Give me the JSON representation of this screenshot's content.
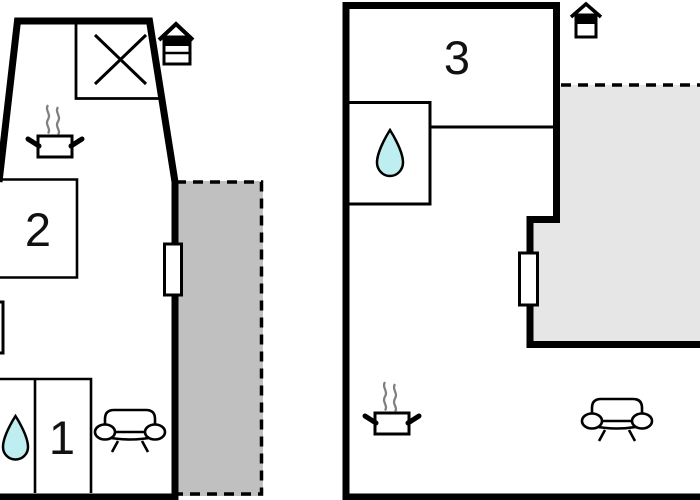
{
  "plans": [
    {
      "name": "floor-plan-left",
      "rooms": [
        {
          "label": "2"
        },
        {
          "label": "1"
        }
      ],
      "icons": [
        "stairs-x-box",
        "entrance-icon",
        "stove-icon",
        "water-drop-icon",
        "sofa-icon"
      ],
      "areas": [
        "terrace"
      ],
      "windows": 3
    },
    {
      "name": "floor-plan-right",
      "rooms": [
        {
          "label": "3"
        }
      ],
      "icons": [
        "entrance-icon",
        "water-drop-icon",
        "stove-icon",
        "sofa-icon"
      ],
      "areas": [
        "terrace"
      ],
      "windows": 1
    }
  ],
  "colors": {
    "wall": "#000000",
    "terrace_left": "#c0c0c0",
    "terrace_right": "#e6e6e6",
    "water_drop": "#bfeef0",
    "steam": "#808080",
    "background": "#ffffff"
  }
}
